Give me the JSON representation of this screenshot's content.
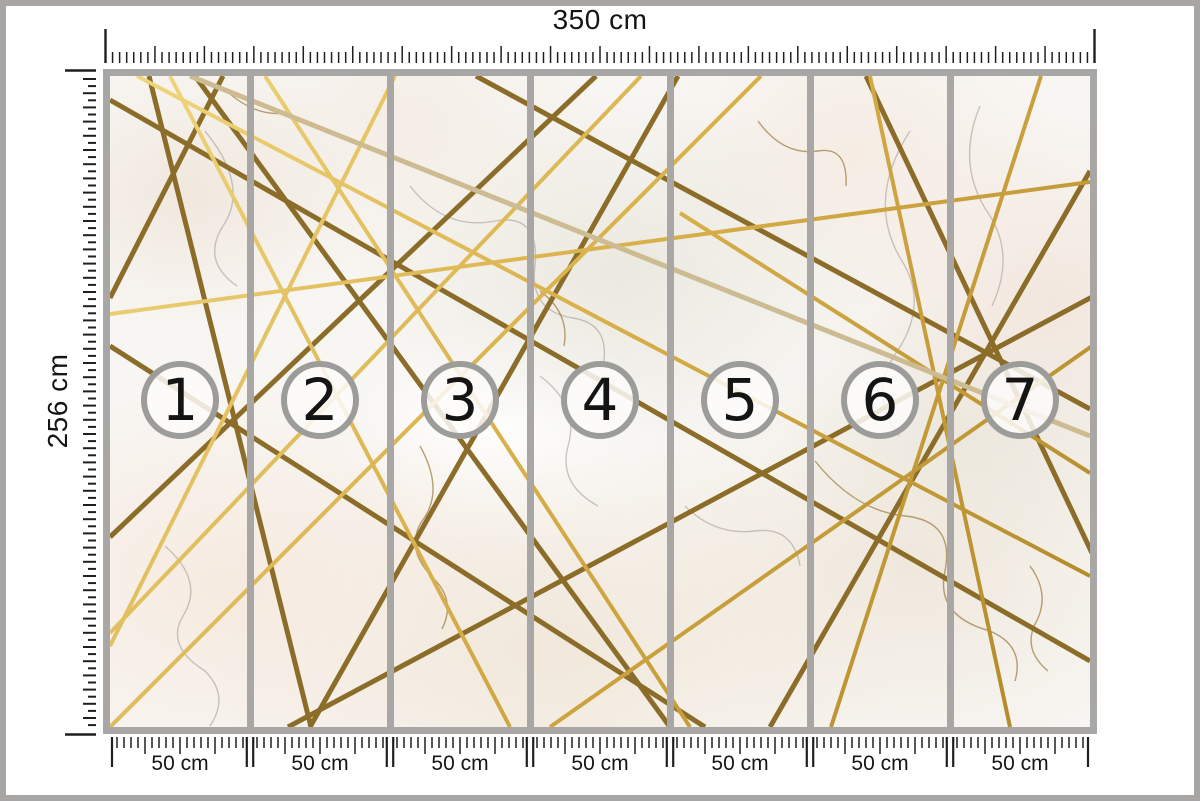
{
  "top_ruler": {
    "label": "350 cm"
  },
  "left_ruler": {
    "label": "256 cm"
  },
  "panels": [
    {
      "number": "1",
      "width_label": "50 cm"
    },
    {
      "number": "2",
      "width_label": "50 cm"
    },
    {
      "number": "3",
      "width_label": "50 cm"
    },
    {
      "number": "4",
      "width_label": "50 cm"
    },
    {
      "number": "5",
      "width_label": "50 cm"
    },
    {
      "number": "6",
      "width_label": "50 cm"
    },
    {
      "number": "7",
      "width_label": "50 cm"
    }
  ],
  "panel_count": 7,
  "colors": {
    "page_frame": "#a8a6a4",
    "divider": "#a9a7a5",
    "circle_ring": "#9c9c9a",
    "tick": "#1f1f1f",
    "label_text": "#151515",
    "gold_dark": "#8b6d29",
    "gold_bright_light": "#f0d77e",
    "gold_bright_deep": "#b08728",
    "gold_pale": "#cdbb92",
    "vein_gray": "#a9a19b",
    "vein_brown": "#93722f"
  },
  "artwork": {
    "dark_lines": [
      [
        39,
        0,
        201,
        651
      ],
      [
        0,
        270,
        595,
        651
      ],
      [
        568,
        0,
        200,
        651
      ],
      [
        366,
        0,
        980,
        333
      ],
      [
        980,
        95,
        660,
        651
      ],
      [
        486,
        0,
        0,
        461
      ],
      [
        0,
        24,
        980,
        585
      ],
      [
        85,
        0,
        560,
        651
      ],
      [
        178,
        651,
        982,
        221
      ],
      [
        756,
        0,
        982,
        477
      ],
      [
        113,
        0,
        0,
        222
      ]
    ],
    "bright_lines": [
      [
        285,
        0,
        0,
        570
      ],
      [
        531,
        0,
        0,
        557
      ],
      [
        60,
        0,
        400,
        651
      ],
      [
        760,
        0,
        900,
        651
      ],
      [
        0,
        238,
        980,
        106
      ],
      [
        570,
        137,
        980,
        397
      ],
      [
        931,
        0,
        721,
        651
      ],
      [
        27,
        0,
        980,
        500
      ],
      [
        155,
        0,
        580,
        651
      ],
      [
        440,
        651,
        982,
        270
      ],
      [
        651,
        0,
        0,
        651
      ]
    ],
    "pale_lines": [
      [
        80,
        0,
        980,
        360
      ]
    ],
    "gray_veins": [
      "M95,55 q45,55 18,95 q-22,35 14,60",
      "M300,110 q35,45 85,35 q45,-8 40,45 q-6,45 38,52 q38,6 30,48",
      "M430,300 q40,30 28,70 q-10,38 30,60",
      "M55,470 q40,35 18,70 q-18,30 22,55 q25,25 5,55",
      "M800,55 q-45,70 -8,130 q28,45 -8,95 q-25,40 5,80",
      "M575,430 q30,30 70,25 q38,-5 45,35",
      "M870,30 q-25,60 10,110 q25,40 2,90"
    ],
    "brown_veins": [
      "M310,370 q25,45 2,75 q-18,28 12,58 q22,22 8,50",
      "M705,385 q40,50 90,55 q50,5 40,55 q-10,45 45,60 q35,15 25,50",
      "M430,215 q30,22 24,55",
      "M648,45 q25,35 60,30 q30,-5 28,35",
      "M120,18 q30,25 60,18",
      "M920,490 q22,30 4,60 q-10,25 14,45"
    ]
  }
}
